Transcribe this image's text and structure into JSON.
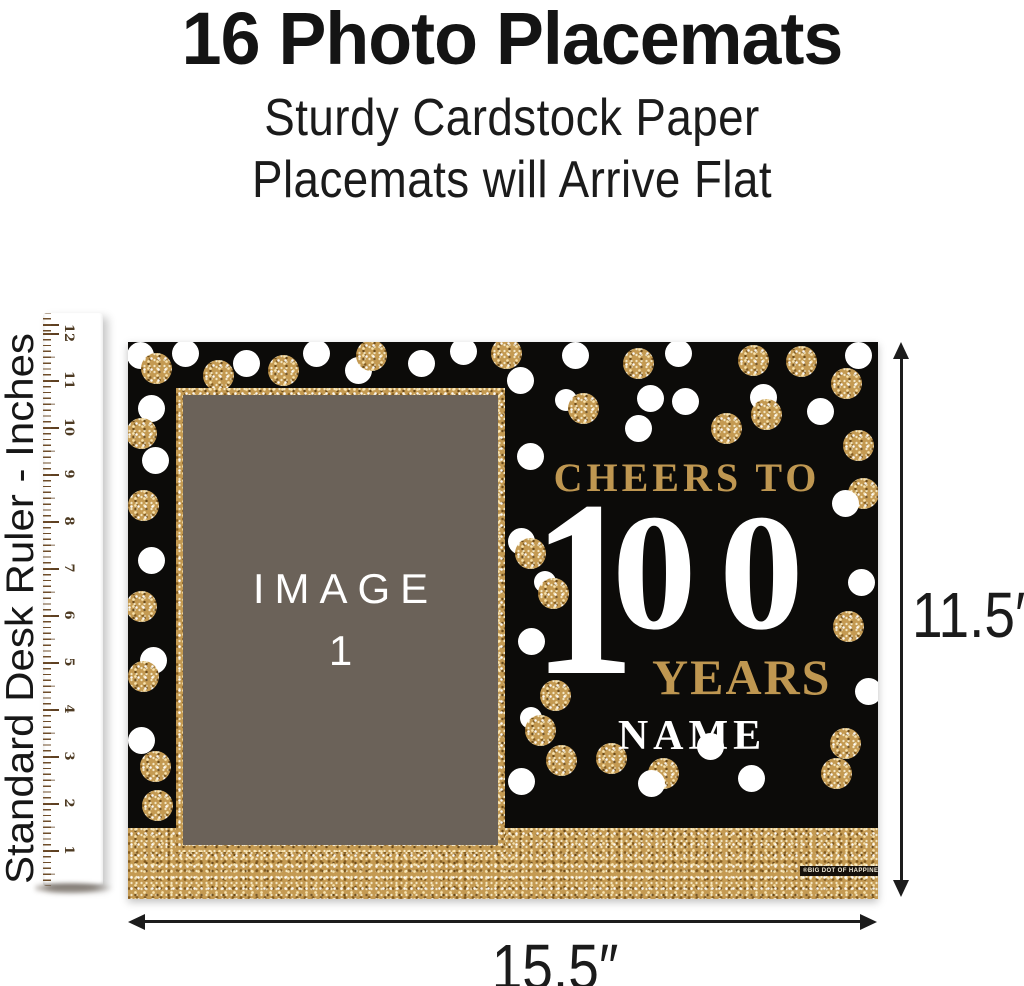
{
  "header": {
    "title": "16 Photo Placemats",
    "subtitle_line1": "Sturdy Cardstock Paper",
    "subtitle_line2": "Placemats will Arrive Flat"
  },
  "ruler": {
    "label": "Standard Desk Ruler - Inches",
    "numbers": [
      "12",
      "11",
      "10",
      "9",
      "8",
      "7",
      "6",
      "5",
      "4",
      "3",
      "2",
      "1"
    ]
  },
  "placemat": {
    "cheers_line": "CHEERS TO",
    "big_number_one": "1",
    "big_number_zeros": "00",
    "years_label": "YEARS",
    "name_label": "NAME",
    "photo_placeholder_line1": "IMAGE",
    "photo_placeholder_line2": "1",
    "brand_tag": "®BIG DOT OF HAPPINESS®"
  },
  "dimensions": {
    "height_label": "11.5″",
    "width_label": "15.5″"
  },
  "colors": {
    "gold_text": "#bf9751",
    "glitter_gold": "#c49a52",
    "placemat_black": "#0c0b09",
    "photo_grey": "#6b6259",
    "dot_white": "#ffffff"
  }
}
